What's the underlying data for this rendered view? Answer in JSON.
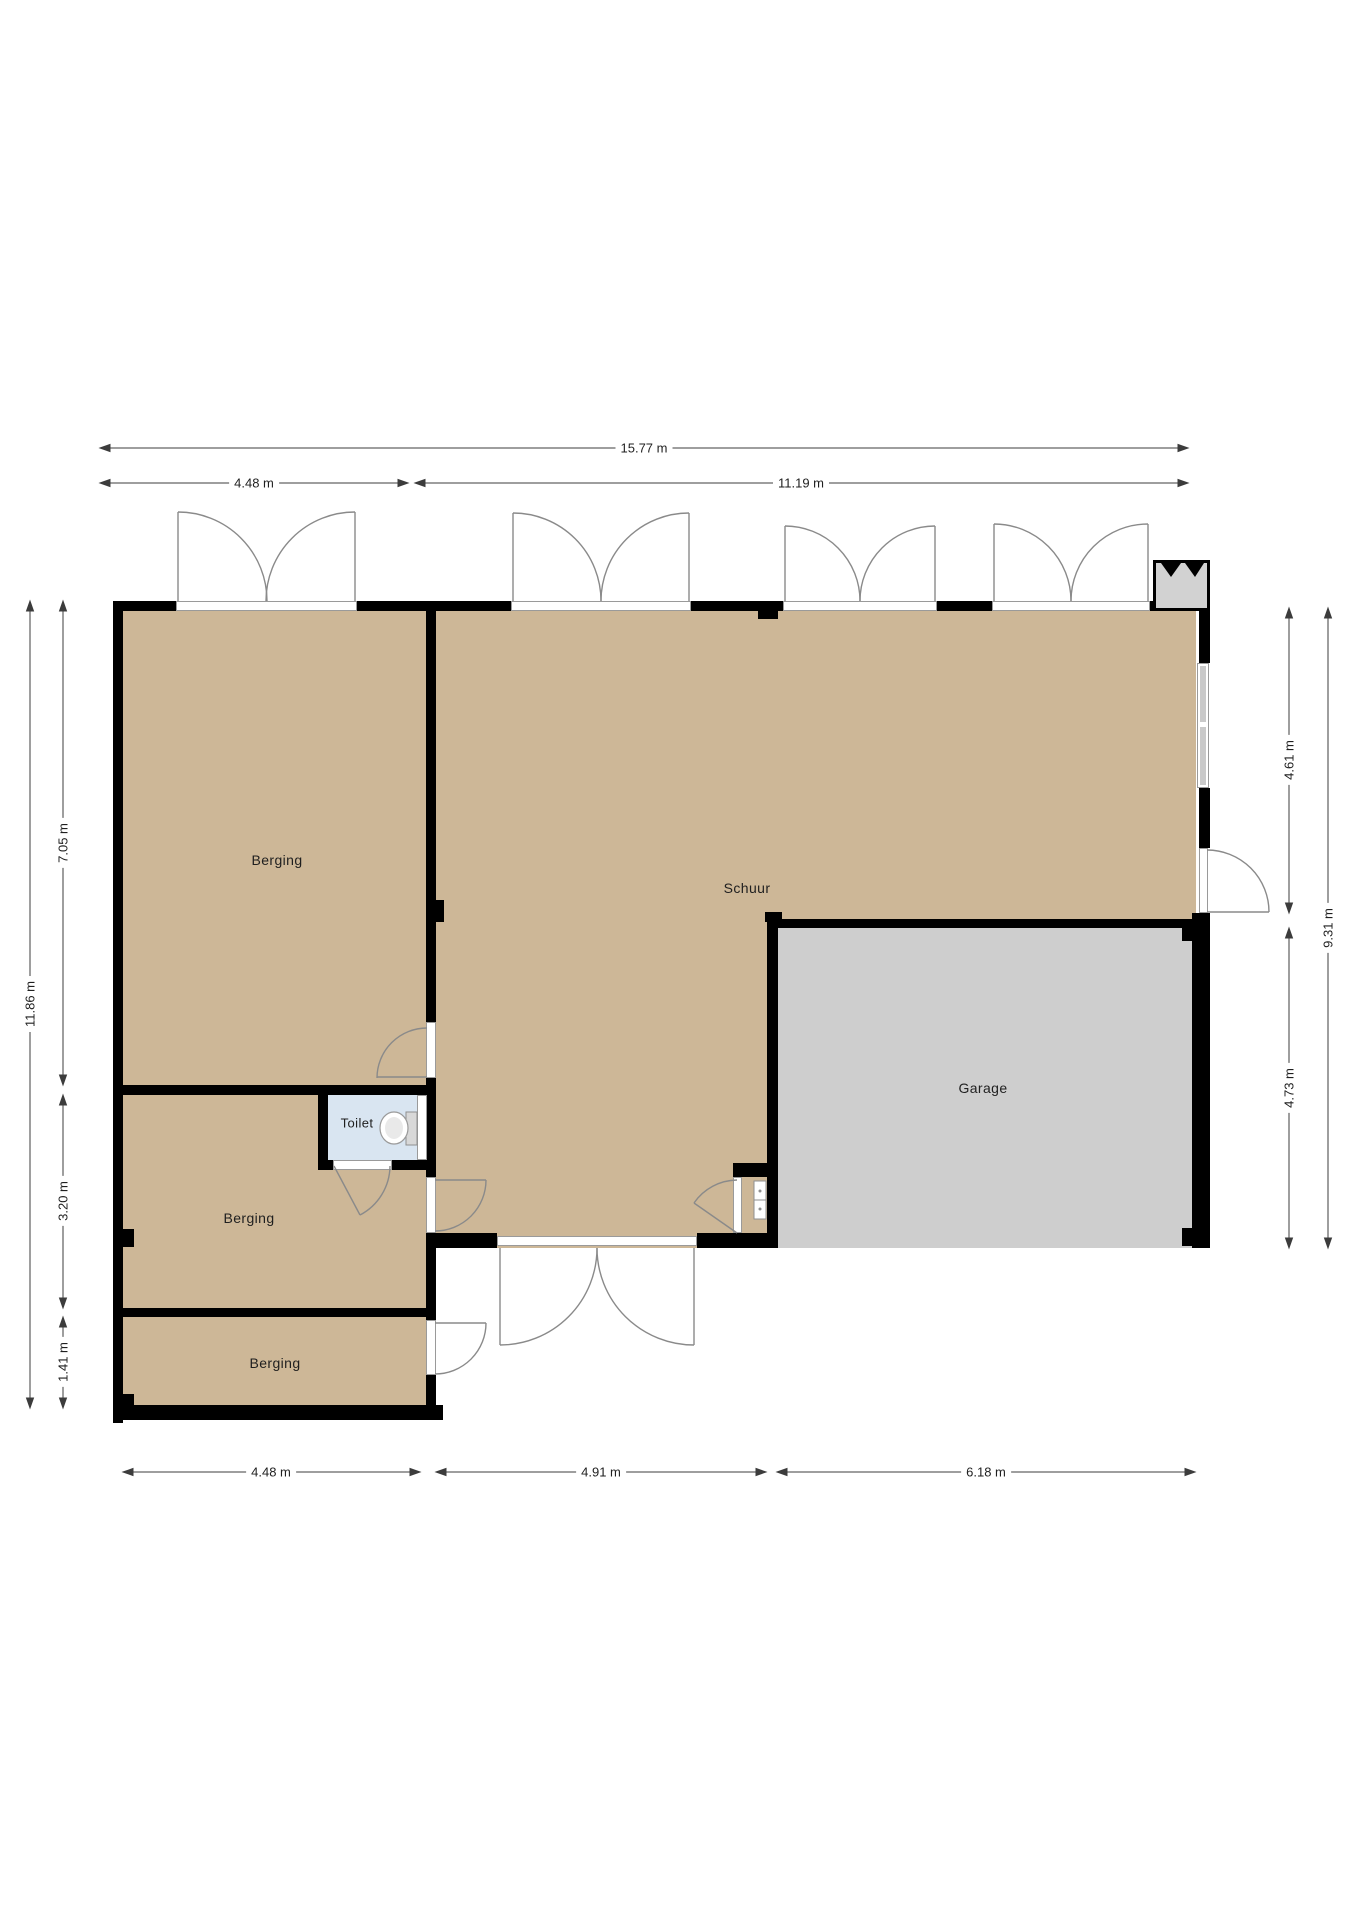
{
  "plan": {
    "rooms": [
      {
        "id": "berging-1",
        "label": "Berging"
      },
      {
        "id": "schuur",
        "label": "Schuur"
      },
      {
        "id": "toilet",
        "label": "Toilet"
      },
      {
        "id": "berging-2",
        "label": "Berging"
      },
      {
        "id": "berging-3",
        "label": "Berging"
      },
      {
        "id": "garage",
        "label": "Garage"
      }
    ],
    "dimensions": {
      "top": [
        {
          "label": "15.77 m"
        },
        {
          "label": "4.48 m"
        },
        {
          "label": "11.19 m"
        }
      ],
      "bottom": [
        {
          "label": "4.48 m"
        },
        {
          "label": "4.91 m"
        },
        {
          "label": "6.18 m"
        }
      ],
      "left": [
        {
          "label": "11.86 m"
        },
        {
          "label": "7.05 m"
        },
        {
          "label": "3.20 m"
        },
        {
          "label": "1.41 m"
        }
      ],
      "right": [
        {
          "label": "4.61 m"
        },
        {
          "label": "4.73 m"
        },
        {
          "label": "9.31 m"
        }
      ]
    },
    "colors": {
      "floor": "#cdb797",
      "garage_floor": "#cecece",
      "toilet_floor": "#d9e5f1",
      "wall": "#000000",
      "dim_line": "#3c3c3c",
      "door_arc": "#8a8a8a",
      "window_fill": "#c9c9c9",
      "fixture": "#d8d8d8"
    }
  }
}
